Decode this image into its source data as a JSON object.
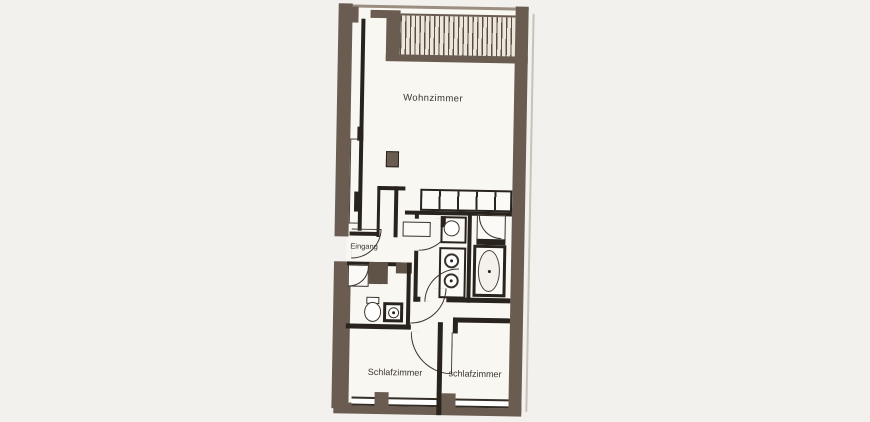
{
  "rooms": {
    "living": {
      "label": "Wohnzimmer"
    },
    "entrance": {
      "label": "Eingang"
    },
    "bedroom_left": {
      "label": "Schlafzimmer"
    },
    "bedroom_right": {
      "label": "schlafzimmer"
    }
  },
  "fixtures": [
    "balcony-decking",
    "kitchen-counter",
    "bathtub",
    "shower",
    "double-washbasin",
    "washbasin",
    "toilet",
    "wardrobe",
    "door-swing",
    "window",
    "column"
  ],
  "colors": {
    "bg": "#f2f1ee",
    "paper": "#f9f7f2",
    "wx": "#6a5c50",
    "wi": "#29231d",
    "ln": "#3a332c"
  }
}
